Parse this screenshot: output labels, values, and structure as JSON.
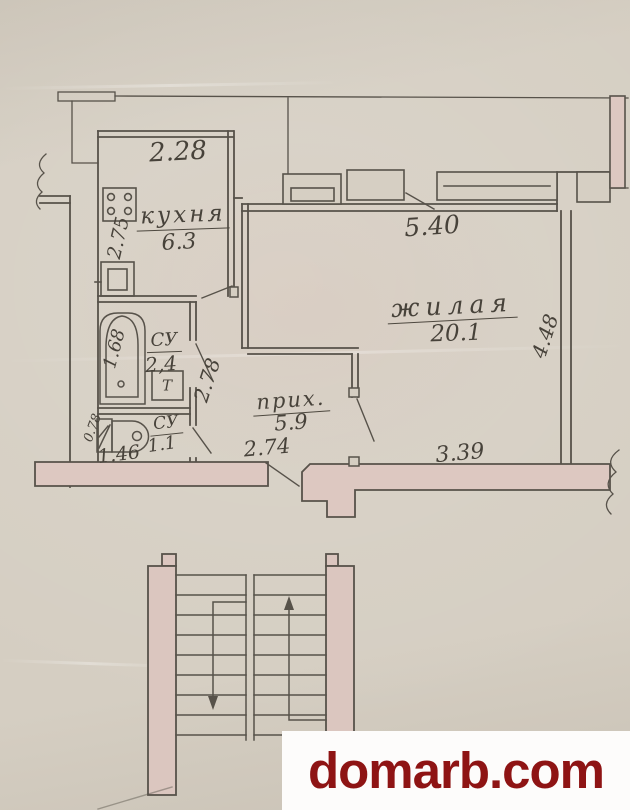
{
  "plan": {
    "rooms": {
      "kitchen": {
        "name": "кухня",
        "area": "6.3"
      },
      "living": {
        "name": "жилая",
        "area": "20.1"
      },
      "hall": {
        "name": "прих.",
        "area": "5.9"
      },
      "bath": {
        "name": "СУ",
        "area": "2,4"
      },
      "wc": {
        "name": "СУ",
        "area": "1.1"
      }
    },
    "dims": {
      "kitchen_width": "2.28",
      "kitchen_depth": "2.75",
      "living_width": "5.40",
      "living_depth": "4.48",
      "living_bottom": "3.39",
      "bath_depth": "1.68",
      "hall_entry": "2.78",
      "hall_width": "2.74",
      "wc_width": "1.46",
      "wc_depth": "0.78"
    },
    "fixtures": {
      "heater_label": "Т"
    }
  },
  "watermark": {
    "text": "domarb.com",
    "color": "#8e1414"
  }
}
